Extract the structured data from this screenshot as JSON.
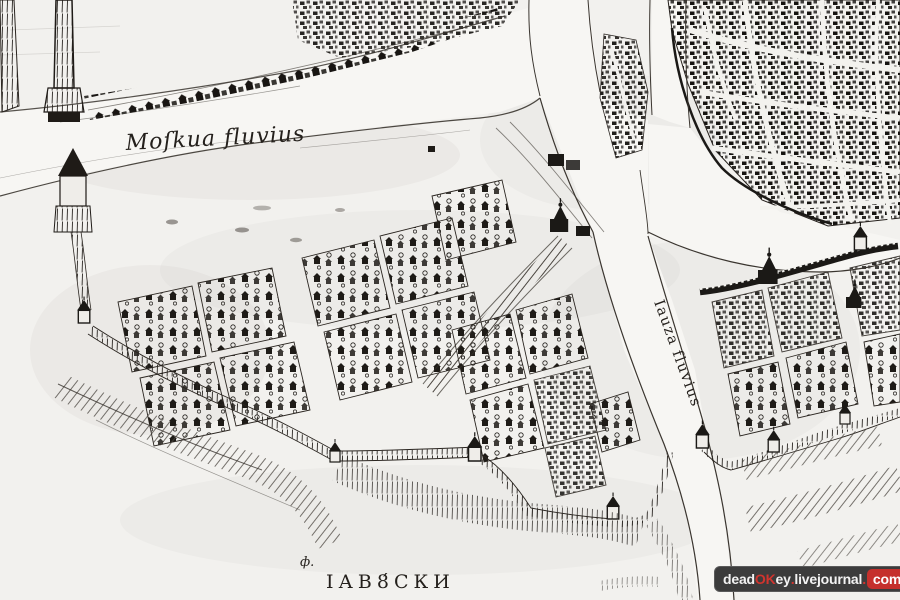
{
  "map": {
    "type": "historic-engraved-city-map",
    "paper_color": "#f2f1ee",
    "ink_color": "#24201c",
    "labels": {
      "moskva_river": "Moſkua fluvius",
      "yauza_river": "Iauza fluvius",
      "district": "ІАВ8́СКИ",
      "small_mark": "ф."
    }
  },
  "watermark": {
    "bg_color": "#3c3c3c",
    "accent_color": "#c5302c",
    "text_color": "#f2f2f2",
    "segments": [
      {
        "text": "dead",
        "style": "white"
      },
      {
        "text": "OK",
        "style": "red"
      },
      {
        "text": "ey",
        "style": "white"
      },
      {
        "text": ".",
        "style": "red"
      },
      {
        "text": "livejournal",
        "style": "white"
      },
      {
        "text": ".",
        "style": "red"
      },
      {
        "text": "com",
        "style": "white-on-red"
      }
    ]
  }
}
